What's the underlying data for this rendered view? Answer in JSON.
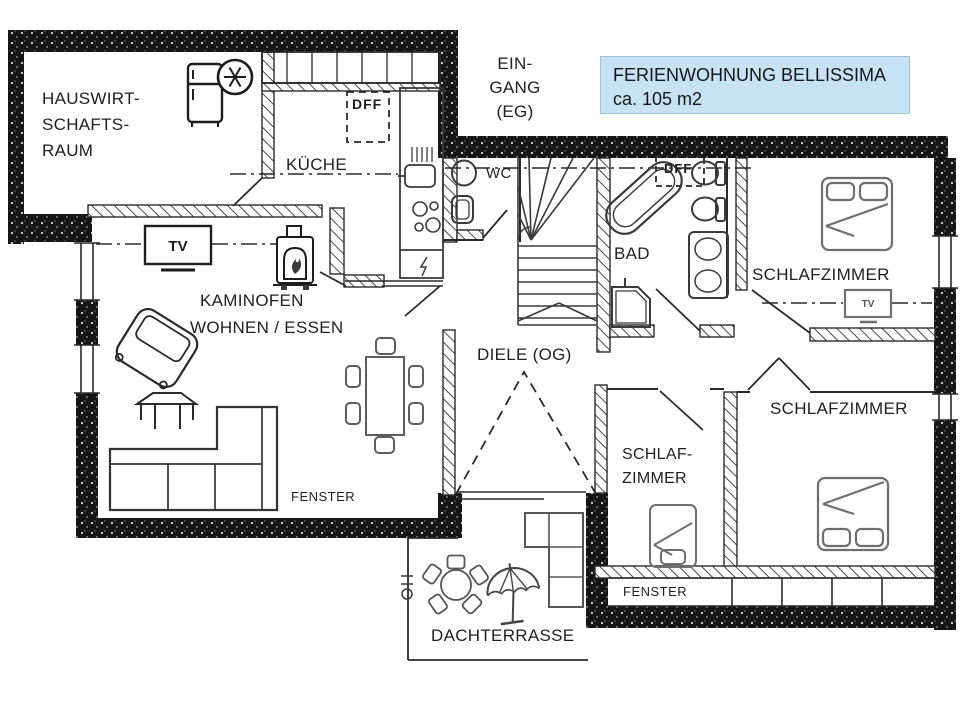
{
  "title_box": {
    "lines": [
      "FERIENWOHNUNG BELLISSIMA",
      "ca. 105 m2"
    ],
    "bg_color": "#c7e2f2",
    "border_color": "#9cc4dc"
  },
  "labels": {
    "utility_room": "HAUSWIRT-\nSCHAFTS-\nRAUM",
    "kitchen": "KÜCHE",
    "entrance": "EIN-\nGANG\n(EG)",
    "wc": "WC",
    "roof_window_kitchen": "DFF",
    "roof_window_bath": "DFF",
    "bath": "BAD",
    "bedroom_top_right": "SCHLAFZIMMER",
    "wood_stove": "KAMINOFEN",
    "living_dining": "WOHNEN / ESSEN",
    "hallway_upper_floor": "DIELE (OG)",
    "bedroom_small": "SCHLAF-\nZIMMER",
    "bedroom_bottom_right": "SCHLAFZIMMER",
    "window_living_room": "FENSTER",
    "window_bedroom": "FENSTER",
    "roof_terrace": "DACHTERRASSE",
    "tv_living_room": "TV",
    "tv_bedroom": "TV"
  },
  "colors": {
    "exterior_wall": "#161616",
    "interior_line": "#2a2a2a",
    "furniture_dark": "#3a3a3a",
    "furniture_gray": "#6e6e6e",
    "title_bg": "#c7e2f2"
  }
}
